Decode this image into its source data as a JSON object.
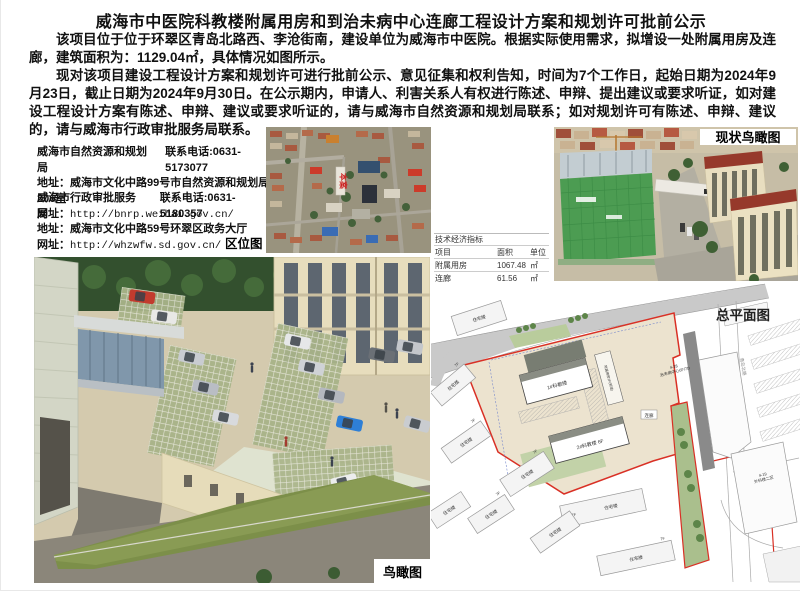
{
  "page": {
    "title": "威海市中医院科教楼附属用房和到治未病中心连廊工程设计方案和规划许可批前公示",
    "paragraph_1": "该项目位于位于环翠区青岛北路西、李沧街南，建设单位为威海市中医院。根据实际使用需求，拟增设一处附属用房及连廊，建筑面积为：1129.04㎡，具体情况如图所示。",
    "paragraph_2": "现对该项目建设工程设计方案和规划许可进行批前公示、意见征集和权利告知，时间为7个工作日，起始日期为2024年9月23日，截止日期为2024年9月30日。在公示期内，申请人、利害关系人有权进行陈述、申辩、提出建议或要求听证，如对建设工程设计方案有陈述、申辩、建议或要求听证的，请与威海市自然资源和规划局联系；如对规划许可有陈述、申辩、建议的，请与威海市行政审批服务局联系。"
  },
  "contacts": [
    {
      "agency": "威海市自然资源和规划局",
      "phone": "联系电话:0631-5173077",
      "address": "地址：威海市文化中路99号市自然资源和规划局206室",
      "website_label": "网址：",
      "website_url": "http://bnrp.weihai.gov.cn/"
    },
    {
      "agency": "威海市行政审批服务局",
      "phone": "联系电话:0631-5180357",
      "address": "地址：威海市文化中路59号环翠区政务大厅",
      "website_label": "网址：",
      "website_url": "http://whzwfw.sd.gov.cn/"
    }
  ],
  "figures": {
    "location_map_label": "区位图",
    "current_aerial_label": "现状鸟瞰图",
    "rendering_label": "鸟瞰图",
    "site_plan_label": "总平面图",
    "site_marker": "本案"
  },
  "indicators_table": {
    "title": "技术经济指标",
    "headers": [
      "项目",
      "面积",
      "单位"
    ],
    "rows": [
      [
        "附属用房",
        "1067.48",
        "㎡"
      ],
      [
        "连廊",
        "61.56",
        "㎡"
      ]
    ]
  },
  "site_plan": {
    "residential": "住宅楼",
    "floors_7f": "7F",
    "building_1": "1#科教楼",
    "building_2": "2#科教楼  6F",
    "annex": "附属用房2F(新增)",
    "corridor": "连廊",
    "zhiweibing_code": "4-28",
    "zhiweibing_name": "治未病中心6F/7D",
    "surgery_code": "4-19",
    "surgery_name": "外科楼二区",
    "road_name": "青岛北路"
  },
  "colors": {
    "boundary_red": "#d93025",
    "site_fill": "#ece3cf",
    "construction_green": "#4c9c52",
    "roof_red": "#96392b"
  }
}
